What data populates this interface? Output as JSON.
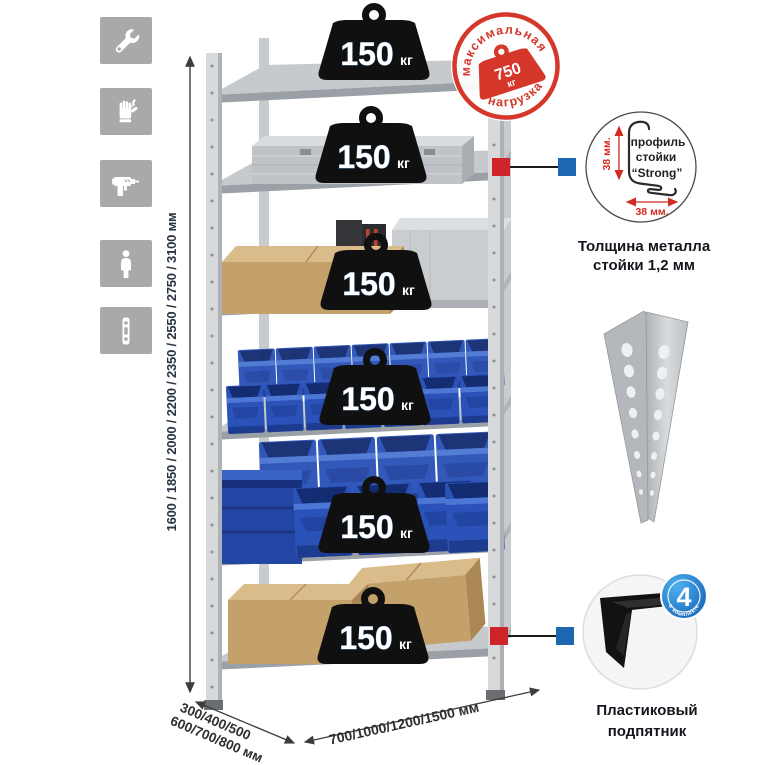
{
  "colors": {
    "accent_red": "#d0242b",
    "accent_blue": "#1d66b0",
    "stamp_red": "#d5382b",
    "bin_blue": "#2a52b8",
    "icon_gray": "#a9a9a9",
    "badge_black": "#101010"
  },
  "left_icons": {
    "items": [
      {
        "name": "wrench-icon"
      },
      {
        "name": "gloves-icon"
      },
      {
        "name": "drill-icon"
      },
      {
        "name": "person-icon"
      },
      {
        "name": "profile-strip-icon"
      }
    ]
  },
  "height_dimension": {
    "label": "1600 / 1850 / 2000 / 2200 / 2350 / 2550 / 2750 / 3100 мм"
  },
  "rack": {
    "shelf_badges": [
      {
        "load": "150",
        "unit": "кг"
      },
      {
        "load": "150",
        "unit": "кг"
      },
      {
        "load": "150",
        "unit": "кг"
      },
      {
        "load": "150",
        "unit": "кг"
      },
      {
        "load": "150",
        "unit": "кг"
      },
      {
        "load": "150",
        "unit": "кг"
      }
    ]
  },
  "max_load_stamp": {
    "arc_top": "максимальная",
    "arc_bottom": "нагрузка",
    "weight": "750",
    "unit": "кг"
  },
  "profile_detail": {
    "label_line1": "профиль",
    "label_line2": "стойки",
    "label_line3": "“Strong”",
    "dim_vertical": "38 мм.",
    "dim_horizontal": "38 мм.",
    "caption_line1": "Толщина металла",
    "caption_line2": "стойки 1,2 мм"
  },
  "foot_detail": {
    "badge_number": "4",
    "badge_arc_text": "в комплекте",
    "caption_line1": "Пластиковый",
    "caption_line2": "подпятник"
  },
  "depth_dimension": {
    "line1": "300/400/500",
    "line2": "600/700/800 мм"
  },
  "width_dimension": {
    "label": "700/1000/1200/1500 мм"
  }
}
